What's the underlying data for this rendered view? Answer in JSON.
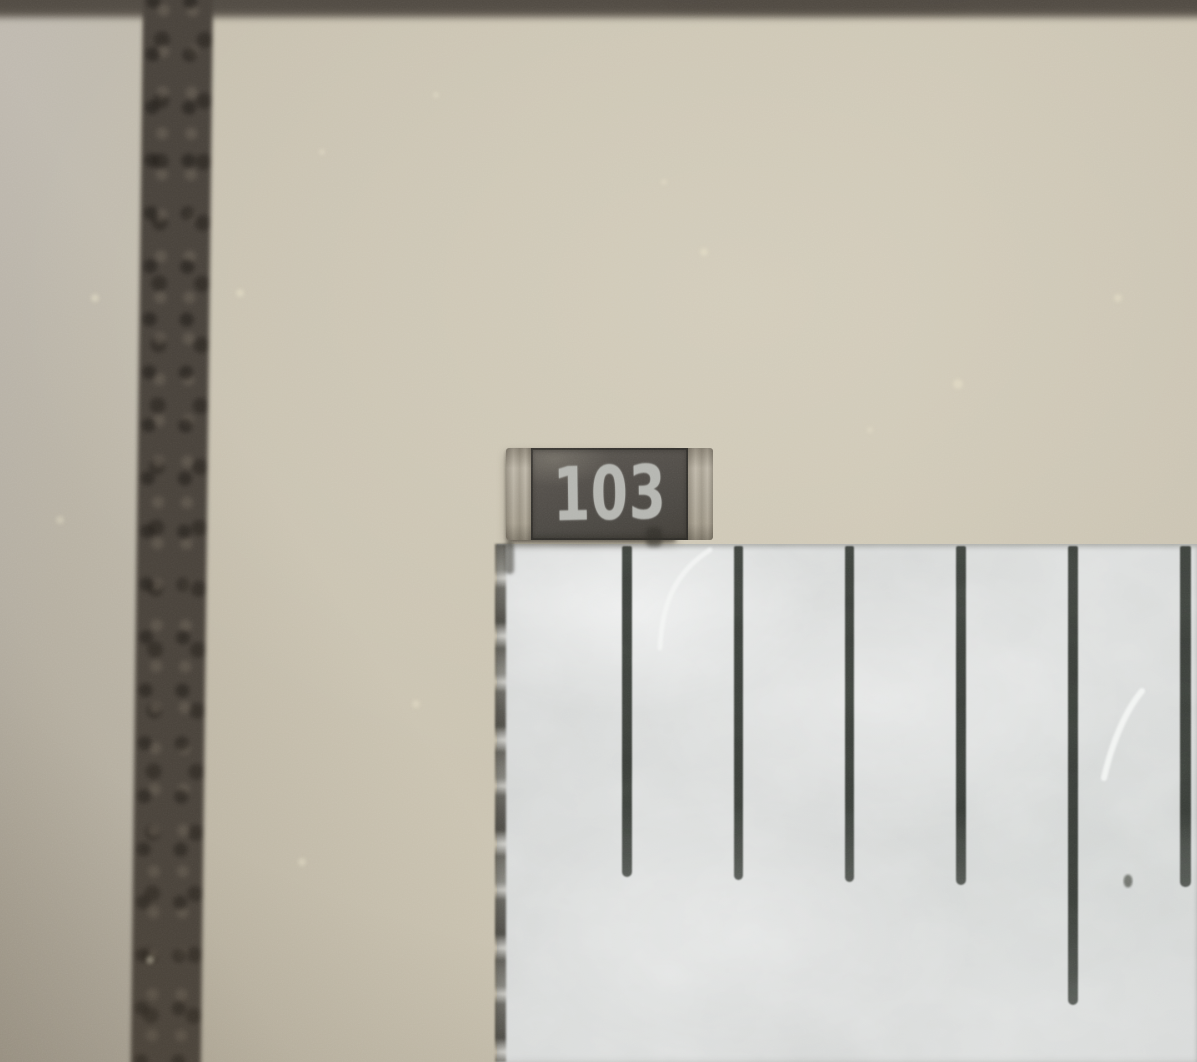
{
  "scene": {
    "type": "macro-photograph",
    "description": "SMD chip resistor beside the edge of a metal ruler on a beige tiled surface",
    "resistor": {
      "marking": "103",
      "body_color": "#4f4c47",
      "cap_color": "#d5d1c8",
      "marking_color": "#b5b6b1",
      "x": 506,
      "y": 448,
      "width": 170,
      "height": 92
    },
    "ruler": {
      "surface_color": "#d6d8d7",
      "tick_color": "#373b36",
      "x": 497,
      "y": 544,
      "ticks": [
        {
          "x": 627,
          "width": 10,
          "top": 546,
          "bottom": 877
        },
        {
          "x": 738,
          "width": 9,
          "top": 546,
          "bottom": 880
        },
        {
          "x": 849,
          "width": 9,
          "top": 546,
          "bottom": 882
        },
        {
          "x": 961,
          "width": 10,
          "top": 546,
          "bottom": 885
        },
        {
          "x": 1073,
          "width": 10,
          "top": 546,
          "bottom": 1005
        },
        {
          "x": 1185,
          "width": 11,
          "top": 546,
          "bottom": 887
        }
      ]
    },
    "background": {
      "tile_color": "#c9c2b1",
      "grout_color": "#48423b",
      "grout_vertical": {
        "x": 143,
        "width": 70
      },
      "grout_top_height": 22
    }
  }
}
